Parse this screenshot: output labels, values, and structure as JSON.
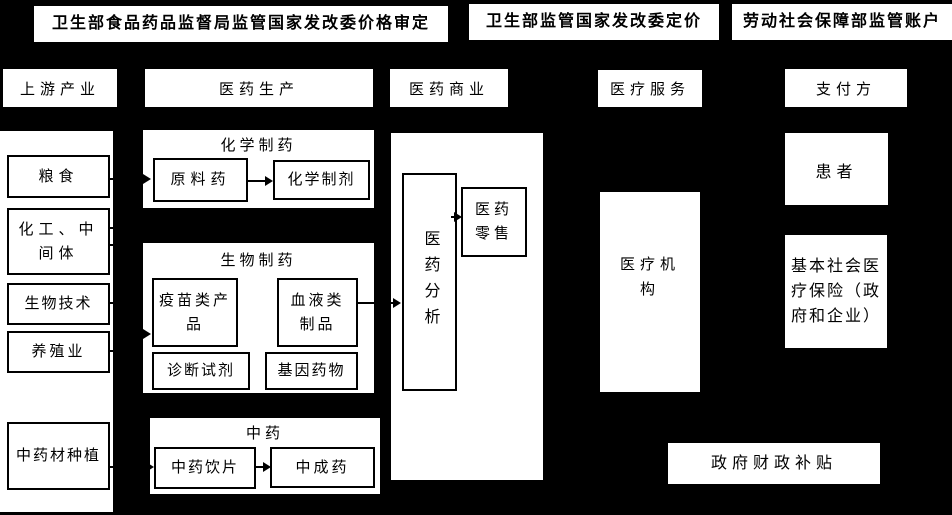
{
  "diagram": {
    "regulators": [
      {
        "label": "卫生部食品药品监督局监管国家发改委价格审定"
      },
      {
        "label": "卫生部监管国家发改委定价"
      },
      {
        "label": "劳动社会保障部监管账户"
      }
    ],
    "stage_headers": [
      {
        "label": "上游产业"
      },
      {
        "label": "医药生产"
      },
      {
        "label": "医药商业"
      },
      {
        "label": "医疗服务"
      },
      {
        "label": "支付方"
      }
    ],
    "upstream": {
      "items": [
        {
          "label": "粮食"
        },
        {
          "label": "化工、中间体"
        },
        {
          "label": "生物技术"
        },
        {
          "label": "养殖业"
        },
        {
          "label": "中药材种植"
        }
      ]
    },
    "production": {
      "chemical": {
        "title": "化学制药",
        "api": "原料药",
        "preparation": "化学制剂"
      },
      "biological": {
        "title": "生物制药",
        "vaccine": "疫苗类产品",
        "blood": "血液类制品",
        "diagnostic": "诊断试剂",
        "gene": "基因药物"
      },
      "tcm": {
        "title": "中药",
        "pieces": "中药饮片",
        "patent": "中成药"
      }
    },
    "commerce": {
      "analysis": "医药分析",
      "retail": "医药零售"
    },
    "service": {
      "hospital": "医疗机构"
    },
    "payer": {
      "patient": "患者",
      "insurance": "基本社会医疗保险（政府和企业）",
      "subsidy": "政府财政补贴"
    },
    "colors": {
      "background": "#000000",
      "panel": "#ffffff",
      "stroke": "#000000"
    }
  }
}
